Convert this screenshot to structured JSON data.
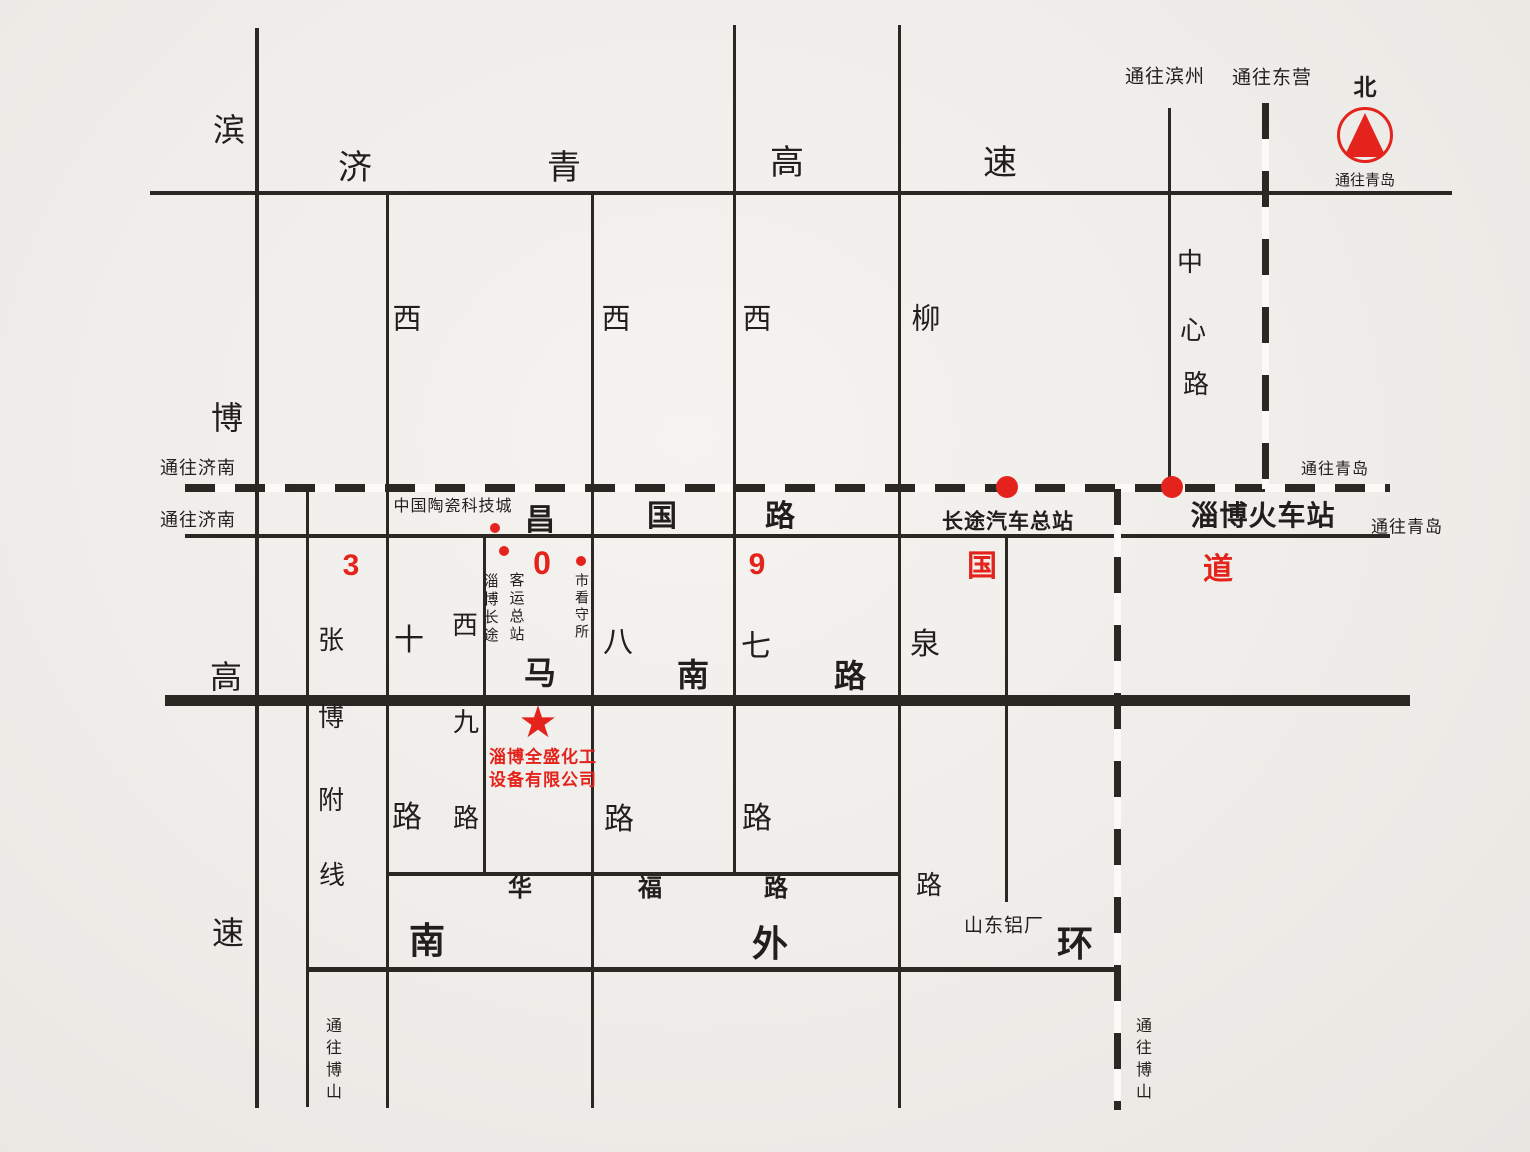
{
  "meta": {
    "background": "#efede9",
    "ink": "#211e1b",
    "red": "#e4231c"
  },
  "roads": {
    "horizontal": [
      {
        "name": "jiqing-expressway",
        "y": 193,
        "x1": 150,
        "x2": 1452,
        "t": 4,
        "style": "solid"
      },
      {
        "name": "railway-dashed-line",
        "y": 488,
        "x1": 185,
        "x2": 1390,
        "t": 8,
        "style": "dashed"
      },
      {
        "name": "changguo-road",
        "y": 536,
        "x1": 185,
        "x2": 1390,
        "t": 4,
        "style": "solid"
      },
      {
        "name": "manan-road",
        "y": 700,
        "x1": 165,
        "x2": 1410,
        "t": 11,
        "style": "solid"
      },
      {
        "name": "huafu-road",
        "y": 874,
        "x1": 387,
        "x2": 901,
        "t": 4,
        "style": "solid"
      },
      {
        "name": "nanwaihuan-road",
        "y": 969,
        "x1": 307,
        "x2": 1121,
        "t": 5,
        "style": "solid"
      }
    ],
    "vertical": [
      {
        "name": "binbo-expressway",
        "x": 257,
        "y1": 28,
        "y2": 1108,
        "t": 4,
        "style": "solid"
      },
      {
        "name": "zhangbo-branch-line",
        "x": 307,
        "y1": 489,
        "y2": 1107,
        "t": 3,
        "style": "solid"
      },
      {
        "name": "xishi-road",
        "x": 387,
        "y1": 193,
        "y2": 1108,
        "t": 3,
        "style": "solid"
      },
      {
        "name": "xijiu-road",
        "x": 484,
        "y1": 536,
        "y2": 874,
        "t": 3,
        "style": "solid"
      },
      {
        "name": "xiba-road",
        "x": 592,
        "y1": 193,
        "y2": 1108,
        "t": 3,
        "style": "solid"
      },
      {
        "name": "xiqi-road",
        "x": 734,
        "y1": 25,
        "y2": 874,
        "t": 3,
        "style": "solid"
      },
      {
        "name": "liuquan-road",
        "x": 899,
        "y1": 25,
        "y2": 1108,
        "t": 3,
        "style": "solid"
      },
      {
        "name": "aluminum-plant-road",
        "x": 1006,
        "y1": 536,
        "y2": 902,
        "t": 3,
        "style": "solid"
      },
      {
        "name": "zhongxin-road",
        "x": 1169,
        "y1": 108,
        "y2": 489,
        "t": 3,
        "style": "solid"
      },
      {
        "name": "dongying-dashed-road",
        "x": 1265,
        "y1": 103,
        "y2": 489,
        "t": 7,
        "style": "dashed"
      },
      {
        "name": "boshan-dashed-road",
        "x": 1117,
        "y1": 489,
        "y2": 1110,
        "t": 7,
        "style": "dashed"
      }
    ]
  },
  "road_labels": [
    {
      "t": "济",
      "x": 355,
      "y": 168,
      "s": 34,
      "w": 400
    },
    {
      "t": "青",
      "x": 564,
      "y": 168,
      "s": 34,
      "w": 400
    },
    {
      "t": "高",
      "x": 787,
      "y": 163,
      "s": 34,
      "w": 400
    },
    {
      "t": "速",
      "x": 1000,
      "y": 163,
      "s": 34,
      "w": 400
    },
    {
      "t": "滨",
      "x": 229,
      "y": 130,
      "s": 32,
      "w": 400
    },
    {
      "t": "博",
      "x": 227,
      "y": 418,
      "s": 32,
      "w": 400
    },
    {
      "t": "高",
      "x": 226,
      "y": 677,
      "s": 32,
      "w": 400
    },
    {
      "t": "速",
      "x": 228,
      "y": 933,
      "s": 32,
      "w": 400
    },
    {
      "t": "西",
      "x": 407,
      "y": 320,
      "s": 29,
      "w": 400
    },
    {
      "t": "西",
      "x": 616,
      "y": 320,
      "s": 29,
      "w": 400
    },
    {
      "t": "西",
      "x": 757,
      "y": 320,
      "s": 29,
      "w": 400
    },
    {
      "t": "柳",
      "x": 926,
      "y": 320,
      "s": 29,
      "w": 400
    },
    {
      "t": "中",
      "x": 1190,
      "y": 262,
      "s": 26,
      "w": 400
    },
    {
      "t": "心",
      "x": 1193,
      "y": 330,
      "s": 26,
      "w": 400
    },
    {
      "t": "路",
      "x": 1196,
      "y": 384,
      "s": 26,
      "w": 400
    },
    {
      "t": "张",
      "x": 331,
      "y": 640,
      "s": 26,
      "w": 400
    },
    {
      "t": "博",
      "x": 331,
      "y": 717,
      "s": 26,
      "w": 400
    },
    {
      "t": "附",
      "x": 331,
      "y": 800,
      "s": 26,
      "w": 400
    },
    {
      "t": "线",
      "x": 332,
      "y": 875,
      "s": 26,
      "w": 400
    },
    {
      "t": "十",
      "x": 409,
      "y": 641,
      "s": 30,
      "w": 400
    },
    {
      "t": "西",
      "x": 465,
      "y": 625,
      "s": 26,
      "w": 400
    },
    {
      "t": "九",
      "x": 466,
      "y": 722,
      "s": 26,
      "w": 400
    },
    {
      "t": "八",
      "x": 618,
      "y": 643,
      "s": 30,
      "w": 400
    },
    {
      "t": "七",
      "x": 756,
      "y": 647,
      "s": 30,
      "w": 400
    },
    {
      "t": "泉",
      "x": 925,
      "y": 645,
      "s": 30,
      "w": 400
    },
    {
      "t": "路",
      "x": 407,
      "y": 818,
      "s": 30,
      "w": 400
    },
    {
      "t": "路",
      "x": 466,
      "y": 818,
      "s": 26,
      "w": 400
    },
    {
      "t": "路",
      "x": 619,
      "y": 820,
      "s": 30,
      "w": 400
    },
    {
      "t": "路",
      "x": 757,
      "y": 819,
      "s": 30,
      "w": 400
    },
    {
      "t": "路",
      "x": 929,
      "y": 885,
      "s": 26,
      "w": 400
    },
    {
      "t": "昌",
      "x": 540,
      "y": 521,
      "s": 30,
      "w": 700
    },
    {
      "t": "国",
      "x": 662,
      "y": 517,
      "s": 30,
      "w": 700
    },
    {
      "t": "路",
      "x": 780,
      "y": 517,
      "s": 30,
      "w": 700
    },
    {
      "t": "马",
      "x": 540,
      "y": 673,
      "s": 32,
      "w": 700
    },
    {
      "t": "南",
      "x": 693,
      "y": 675,
      "s": 32,
      "w": 700
    },
    {
      "t": "路",
      "x": 850,
      "y": 676,
      "s": 32,
      "w": 700
    },
    {
      "t": "华",
      "x": 520,
      "y": 889,
      "s": 24,
      "w": 700
    },
    {
      "t": "福",
      "x": 650,
      "y": 889,
      "s": 24,
      "w": 700
    },
    {
      "t": "路",
      "x": 776,
      "y": 889,
      "s": 24,
      "w": 700
    },
    {
      "t": "南",
      "x": 427,
      "y": 941,
      "s": 36,
      "w": 700
    },
    {
      "t": "外",
      "x": 770,
      "y": 944,
      "s": 36,
      "w": 700
    },
    {
      "t": "环",
      "x": 1075,
      "y": 944,
      "s": 36,
      "w": 700
    }
  ],
  "direction_labels": [
    {
      "t": "通往济南",
      "x": 198,
      "y": 468,
      "s": 18
    },
    {
      "t": "通往济南",
      "x": 198,
      "y": 520,
      "s": 18
    },
    {
      "t": "通往滨州",
      "x": 1165,
      "y": 77,
      "s": 19
    },
    {
      "t": "通往东营",
      "x": 1272,
      "y": 78,
      "s": 19
    },
    {
      "t": "通往青岛",
      "x": 1335,
      "y": 470,
      "s": 16
    },
    {
      "t": "通往青岛",
      "x": 1407,
      "y": 527,
      "s": 17
    },
    {
      "t": "通往博山",
      "x": 331,
      "y": 1061,
      "s": 16,
      "vert": true
    },
    {
      "t": "通往博山",
      "x": 1141,
      "y": 1061,
      "s": 16,
      "vert": true
    }
  ],
  "landmarks": [
    {
      "t": "中国陶瓷科技城",
      "x": 453,
      "y": 507,
      "s": 16
    },
    {
      "t": "长途汽车总站",
      "x": 1008,
      "y": 522,
      "s": 21,
      "w": 600
    },
    {
      "t": "淄博火车站",
      "x": 1263,
      "y": 516,
      "s": 28,
      "w": 700
    },
    {
      "t": "山东铝厂",
      "x": 1004,
      "y": 926,
      "s": 19
    },
    {
      "t": "淄博长途",
      "x": 490,
      "y": 609,
      "s": 15,
      "vert": true
    },
    {
      "t": "客运总站",
      "x": 516,
      "y": 608,
      "s": 15,
      "vert": true
    },
    {
      "t": "市看守所",
      "x": 582,
      "y": 607,
      "s": 14,
      "vert": true
    }
  ],
  "highway309": {
    "labels": [
      {
        "t": "3",
        "x": 351,
        "y": 566,
        "s": 30
      },
      {
        "t": "0",
        "x": 542,
        "y": 563,
        "s": 32
      },
      {
        "t": "9",
        "x": 757,
        "y": 565,
        "s": 30
      },
      {
        "t": "国",
        "x": 982,
        "y": 567,
        "s": 30
      },
      {
        "t": "道",
        "x": 1218,
        "y": 570,
        "s": 30
      }
    ],
    "dots": [
      {
        "x": 495,
        "y": 528,
        "r": 5
      },
      {
        "x": 504,
        "y": 551,
        "r": 5
      },
      {
        "x": 581,
        "y": 561,
        "r": 5
      },
      {
        "x": 1007,
        "y": 487,
        "r": 11
      },
      {
        "x": 1172,
        "y": 487,
        "r": 11
      }
    ]
  },
  "company": {
    "star": "★",
    "star_x": 538,
    "star_y": 723,
    "star_s": 44,
    "line1": "淄博全盛化工",
    "line2": "设备有限公司",
    "x": 543,
    "y1": 757,
    "y2": 780,
    "s": 17
  },
  "compass": {
    "north": "北",
    "to_qingdao": "通往青岛"
  }
}
